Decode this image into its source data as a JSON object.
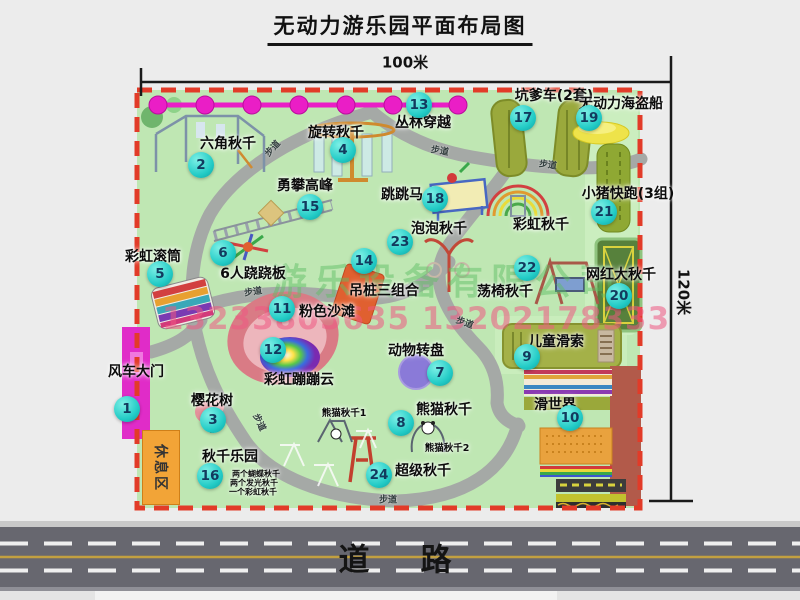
{
  "title": "无动力游乐园平面布局图",
  "dimensions": {
    "width": "100米",
    "height": "120米"
  },
  "road": {
    "label": "道　路"
  },
  "watermark": {
    "company": "游乐设备有限公司",
    "phone": "13233805635 13202178333"
  },
  "park": {
    "rest_area": "休息区",
    "path_label_text": "步道",
    "attractions": [
      {
        "num": "1",
        "label": "风车大门",
        "cx": 127,
        "cy": 409,
        "lx": 136,
        "ly": 371
      },
      {
        "num": "2",
        "label": "六角秋千",
        "cx": 201,
        "cy": 165,
        "lx": 228,
        "ly": 143
      },
      {
        "num": "3",
        "label": "樱花树",
        "cx": 213,
        "cy": 420,
        "lx": 212,
        "ly": 400
      },
      {
        "num": "4",
        "label": "旋转秋千",
        "cx": 343,
        "cy": 150,
        "lx": 336,
        "ly": 132
      },
      {
        "num": "5",
        "label": "彩虹滚筒",
        "cx": 160,
        "cy": 274,
        "lx": 153,
        "ly": 256
      },
      {
        "num": "6",
        "label": "6人跷跷板",
        "cx": 223,
        "cy": 253,
        "lx": 253,
        "ly": 273
      },
      {
        "num": "7",
        "label": "动物转盘",
        "cx": 440,
        "cy": 373,
        "lx": 416,
        "ly": 350
      },
      {
        "num": "8",
        "label": "熊猫秋千",
        "cx": 401,
        "cy": 423,
        "lx": 444,
        "ly": 409
      },
      {
        "num": "9",
        "label": "儿童滑索",
        "cx": 527,
        "cy": 357,
        "lx": 556,
        "ly": 341
      },
      {
        "num": "10",
        "label": "滑世界",
        "cx": 570,
        "cy": 418,
        "lx": 555,
        "ly": 404
      },
      {
        "num": "11",
        "label": "粉色沙滩",
        "cx": 282,
        "cy": 309,
        "lx": 327,
        "ly": 311
      },
      {
        "num": "12",
        "label": "彩虹蹦蹦云",
        "cx": 273,
        "cy": 350,
        "lx": 299,
        "ly": 379
      },
      {
        "num": "13",
        "label": "丛林穿越",
        "cx": 419,
        "cy": 105,
        "lx": 423,
        "ly": 122
      },
      {
        "num": "14",
        "label": "吊桩三组合",
        "cx": 364,
        "cy": 261,
        "lx": 384,
        "ly": 290
      },
      {
        "num": "15",
        "label": "勇攀高峰",
        "cx": 310,
        "cy": 207,
        "lx": 305,
        "ly": 185
      },
      {
        "num": "16",
        "label": "秋千乐园",
        "cx": 210,
        "cy": 476,
        "lx": 230,
        "ly": 456
      },
      {
        "num": "17",
        "label": "坑爹车(2套)",
        "cx": 523,
        "cy": 118,
        "lx": 554,
        "ly": 95
      },
      {
        "num": "18",
        "label": "跳跳马",
        "cx": 435,
        "cy": 199,
        "lx": 402,
        "ly": 194
      },
      {
        "num": "19",
        "label": "无动力海盗船",
        "cx": 589,
        "cy": 118,
        "lx": 621,
        "ly": 103
      },
      {
        "num": "20",
        "label": "网红大秋千",
        "cx": 619,
        "cy": 296,
        "lx": 621,
        "ly": 274
      },
      {
        "num": "21",
        "label": "小猪快跑(3组)",
        "cx": 604,
        "cy": 212,
        "lx": 628,
        "ly": 193
      },
      {
        "num": "22",
        "label": "荡椅秋千",
        "cx": 527,
        "cy": 268,
        "lx": 505,
        "ly": 291
      },
      {
        "num": "23",
        "label": "泡泡秋千",
        "cx": 400,
        "cy": 242,
        "lx": 439,
        "ly": 228
      },
      {
        "num": "24",
        "label": "超级秋千",
        "cx": 379,
        "cy": 475,
        "lx": 423,
        "ly": 470
      }
    ],
    "extra_labels": [
      {
        "text": "彩虹秋千",
        "x": 541,
        "y": 224,
        "size": 14
      },
      {
        "text": "熊猫秋千1",
        "x": 344,
        "y": 412,
        "size": 9.5
      },
      {
        "text": "熊猫秋千2",
        "x": 447,
        "y": 447,
        "size": 9.5
      },
      {
        "text": "两个蝴蝶秋千",
        "x": 256,
        "y": 474,
        "size": 8
      },
      {
        "text": "两个发光秋千",
        "x": 254,
        "y": 483,
        "size": 8
      },
      {
        "text": "一个彩虹秋千",
        "x": 253,
        "y": 492,
        "size": 8
      }
    ],
    "path_labels": [
      {
        "x": 272,
        "y": 148,
        "rot": -48
      },
      {
        "x": 440,
        "y": 150,
        "rot": 10
      },
      {
        "x": 548,
        "y": 164,
        "rot": 8
      },
      {
        "x": 253,
        "y": 291,
        "rot": -8
      },
      {
        "x": 465,
        "y": 322,
        "rot": 20
      },
      {
        "x": 388,
        "y": 499,
        "rot": 0
      },
      {
        "x": 260,
        "y": 422,
        "rot": 65
      }
    ]
  },
  "colors": {
    "park_green": "#bfe7b3",
    "border_red": "#e23b28",
    "badge_cyan": "#22cbc6",
    "gate_magenta": "#e02cc8",
    "chain_magenta": "#ea1ec6",
    "road_gray": "#67676f",
    "watermark_green": "#5fbe64",
    "watermark_pink": "#ee5882",
    "rest_area_orange": "#f2a437"
  }
}
